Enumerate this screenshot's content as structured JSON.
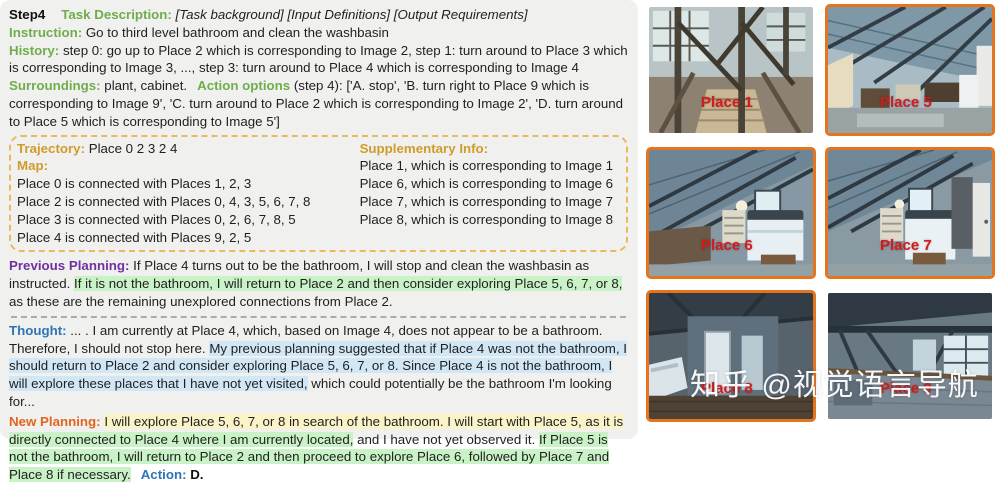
{
  "panel": {
    "step": "Step4",
    "task_label": "Task Description:",
    "task_value": "[Task background] [Input Definitions] [Output Requirements]",
    "instruction_label": "Instruction:",
    "instruction_value": "Go to third level bathroom and clean the washbasin",
    "history_label": "History:",
    "history_value": "step 0: go up to Place 2 which is corresponding to Image 2, step 1: turn around to Place 3 which is corresponding to Image 3, ..., step 3: turn around to Place 4 which is corresponding to Image 4",
    "surroundings_label": "Surroundings:",
    "surroundings_value": "plant, cabinet.",
    "action_options_label": "Action options",
    "action_options_value": "(step 4): ['A. stop', 'B. turn right to Place 9 which is corresponding to Image 9', 'C. turn around to Place 2 which is corresponding to Image 2', 'D. turn around to Place 5 which is corresponding to Image 5']"
  },
  "box": {
    "trajectory_label": "Trajectory:",
    "trajectory_value": "Place 0 2 3 2 4",
    "map_label": "Map:",
    "map_lines": [
      "Place 0 is connected with Places 1, 2, 3",
      "Place 2 is connected with Places 0, 4, 3, 5, 6, 7, 8",
      "Place 3 is connected with Places 0, 2, 6, 7, 8, 5",
      "Place 4 is connected with Places 9, 2, 5"
    ],
    "supp_label": "Supplementary Info:",
    "supp_lines": [
      "Place 1, which is corresponding to Image 1",
      "Place 6, which is corresponding to Image 6",
      "Place 7, which is corresponding to Image 7",
      "Place 8, which is corresponding to Image 8"
    ]
  },
  "previous_planning": {
    "label": "Previous Planning:",
    "lead": "If Place 4 turns out to be the bathroom, I will stop and clean the washbasin as instructed. ",
    "highlight_green": "If it is not the bathroom, I will return to Place 2 and then consider exploring Place 5, 6, 7, or 8,",
    "tail": " as these are the remaining unexplored connections from Place 2."
  },
  "thought": {
    "label": "Thought:",
    "lead": "... . I am currently at Place 4, which, based on Image 4, does not appear to be a bathroom. Therefore, I should not stop here. ",
    "highlight_blue": "My previous planning suggested that if Place 4 was not the bathroom, I should return to Place 2 and consider exploring Place 5, 6, 7, or 8. Since Place 4 is not the bathroom, I will explore these places that I have not yet visited,",
    "tail": " which could potentially be the bathroom I'm looking for..."
  },
  "new_planning": {
    "label": "New Planning:",
    "highlight_yellow": "I will explore Place 5, 6, 7, or 8 in search of the bathroom. I will start with Place 5, as it is ",
    "highlight_green": "directly connected to Place 4 where I am currently located,",
    "plain": " and I have not yet observed it. ",
    "highlight_green2": "If Place 5 is not the bathroom, I will return to Place 2 and then proceed to explore Place 6, followed by Place 7 and Place 8 if necessary.",
    "action_label": "Action:",
    "action_value": "D."
  },
  "gallery": {
    "images": [
      {
        "label": "Place 1",
        "bordered": false
      },
      {
        "label": "Place 5",
        "bordered": true
      },
      {
        "label": "Place 6",
        "bordered": true
      },
      {
        "label": "Place 7",
        "bordered": true
      },
      {
        "label": "Place 8",
        "bordered": true
      },
      {
        "label": "Place 9",
        "bordered": false
      }
    ],
    "watermark": "知乎 @视觉语言导航"
  },
  "colors": {
    "panel_bg": "#f0f0ee",
    "green_label": "#6fad4d",
    "gold_label": "#cf9c2a",
    "purple_label": "#7030a0",
    "blue_label": "#2e74b5",
    "orange_label": "#e2641e",
    "highlight_green": "#c9f2c6",
    "highlight_blue": "#d2e7f6",
    "highlight_yellow": "#fbf3c8",
    "dashed_box_border": "#e9b95b",
    "image_border_orange": "#e5741e",
    "place_label_red": "#cf1d1d"
  }
}
